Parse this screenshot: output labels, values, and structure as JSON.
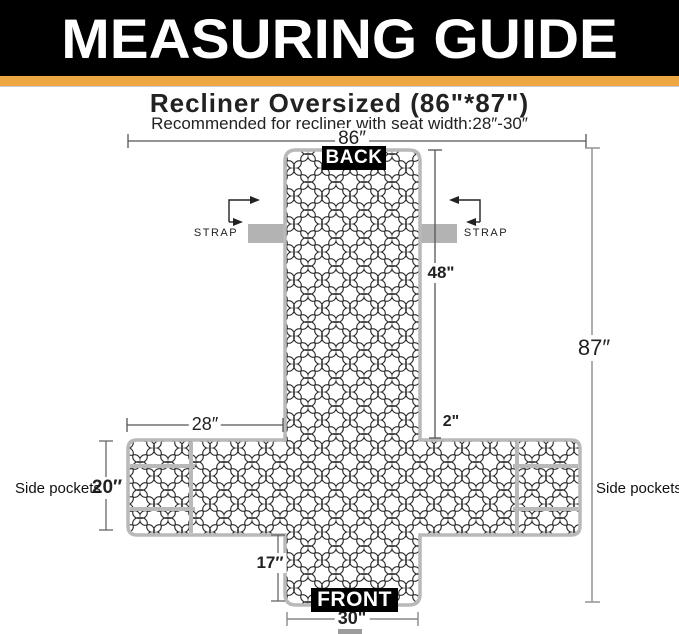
{
  "header": {
    "title": "MEASURING GUIDE"
  },
  "product": {
    "title": "Recliner  Oversized (86\"*87\")",
    "subtitle": "Recommended for recliner with seat width:28″-30″"
  },
  "diagram": {
    "labels": {
      "back": "BACK",
      "front": "FRONT",
      "strap_left": "STRAP",
      "strap_right": "STRAP",
      "side_pockets_left": "Side pockets",
      "side_pockets_right": "Side pockets"
    },
    "dimensions": {
      "total_width": "86″",
      "total_length": "87″",
      "back_height": "48\"",
      "back_edge_gap": "2\"",
      "seat_side_width": "28″",
      "pocket_height": "20″",
      "front_height": "17″",
      "front_width": "30\""
    }
  },
  "colors": {
    "banner_background": "#000000",
    "accent_stripe": "#EDA843",
    "cover_outline": "#b9b9b9",
    "strap_gray": "#b3b3b3",
    "pattern_line": "#2b2b2b",
    "dimension_line": "#555555"
  }
}
